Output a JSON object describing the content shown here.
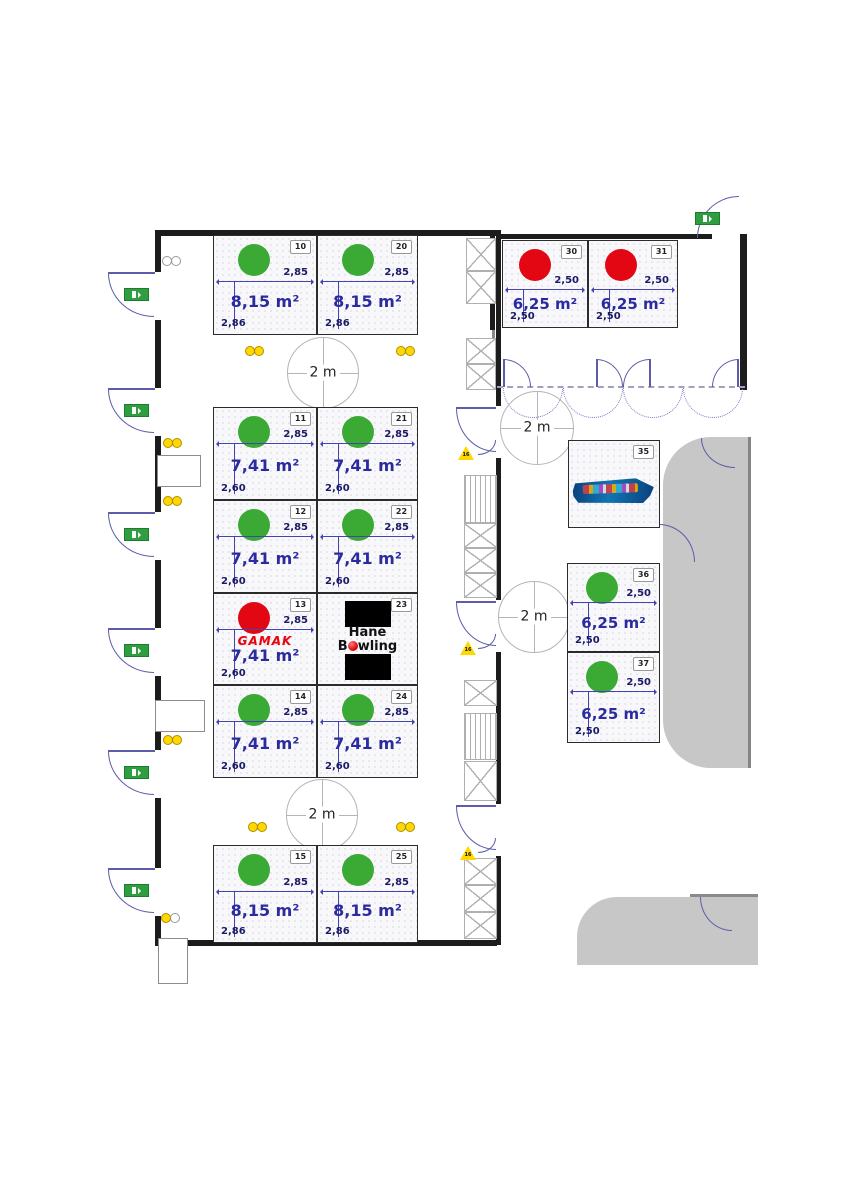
{
  "palette": {
    "available_green": "#3aaa35",
    "reserved_red": "#e30613",
    "area_text_blue": "#2b2b9e",
    "dim_text_navy": "#1a1a66",
    "wall_black": "#1c1c1c",
    "door_blue": "#5c5caa",
    "socket_yellow": "#ffd800",
    "exit_green": "#2f9e41",
    "gray_area": "#c7c7c7"
  },
  "booths": [
    {
      "num": "10",
      "area": "8,15 m²",
      "dim_top": "2,85",
      "dim_side": "2,86",
      "status": "available"
    },
    {
      "num": "20",
      "area": "8,15 m²",
      "dim_top": "2,85",
      "dim_side": "2,86",
      "status": "available"
    },
    {
      "num": "11",
      "area": "7,41 m²",
      "dim_top": "2,85",
      "dim_side": "2,60",
      "status": "available"
    },
    {
      "num": "21",
      "area": "7,41 m²",
      "dim_top": "2,85",
      "dim_side": "2,60",
      "status": "available"
    },
    {
      "num": "12",
      "area": "7,41 m²",
      "dim_top": "2,85",
      "dim_side": "2,60",
      "status": "available"
    },
    {
      "num": "22",
      "area": "7,41 m²",
      "dim_top": "2,85",
      "dim_side": "2,60",
      "status": "available"
    },
    {
      "num": "13",
      "area": "7,41 m²",
      "dim_top": "2,85",
      "dim_side": "2,60",
      "status": "reserved"
    },
    {
      "num": "23",
      "area": "",
      "dim_top": "",
      "dim_side": "",
      "status": "branded"
    },
    {
      "num": "14",
      "area": "7,41 m²",
      "dim_top": "2,85",
      "dim_side": "2,60",
      "status": "available"
    },
    {
      "num": "24",
      "area": "7,41 m²",
      "dim_top": "2,85",
      "dim_side": "2,60",
      "status": "available"
    },
    {
      "num": "15",
      "area": "8,15 m²",
      "dim_top": "2,85",
      "dim_side": "2,86",
      "status": "available"
    },
    {
      "num": "25",
      "area": "8,15 m²",
      "dim_top": "2,85",
      "dim_side": "2,86",
      "status": "available"
    },
    {
      "num": "30",
      "area": "6,25 m²",
      "dim_top": "2,50",
      "dim_side": "2,50",
      "status": "reserved"
    },
    {
      "num": "31",
      "area": "6,25 m²",
      "dim_top": "2,50",
      "dim_side": "2,50",
      "status": "reserved"
    },
    {
      "num": "35",
      "area": "",
      "dim_top": "",
      "dim_side": "",
      "status": "branded"
    },
    {
      "num": "36",
      "area": "6,25 m²",
      "dim_top": "2,50",
      "dim_side": "2,50",
      "status": "available"
    },
    {
      "num": "37",
      "area": "6,25 m²",
      "dim_top": "2,50",
      "dim_side": "2,50",
      "status": "available"
    }
  ],
  "circles": [
    "2 m",
    "2 m",
    "2 m",
    "2 m"
  ],
  "warnings": {
    "label": "16"
  },
  "logos": {
    "gamak": "GAMAK",
    "hane": {
      "line1": "Hane",
      "line2_pre": "B",
      "line2_ball": "o",
      "line2_post": "wling"
    }
  }
}
